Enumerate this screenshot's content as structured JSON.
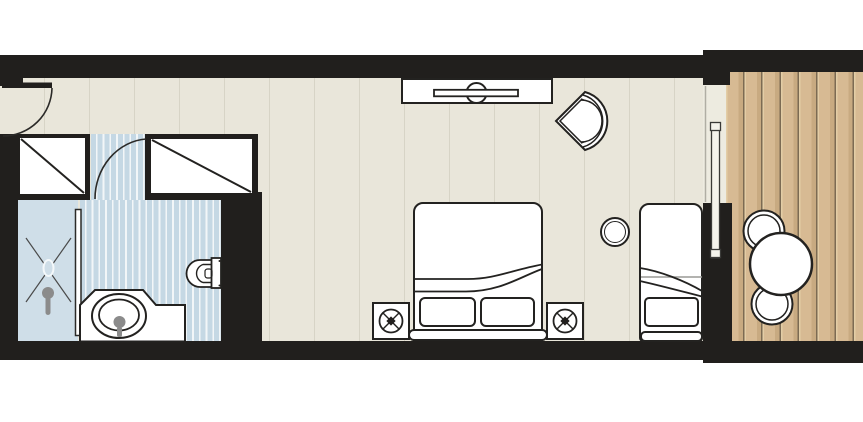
{
  "title": "hotel-room-floor-plan",
  "colors": {
    "page": "#ffffff",
    "wall": "#211f1d",
    "line": "#232220",
    "floor": "#e9e6da",
    "threshold": "#edebe0",
    "shower": "#cfdee8",
    "bath": "#c5d8e4",
    "bath-stripe": "#f2f6f8",
    "deck": "#d7ba93",
    "deck-light": "#e3cda6",
    "deck-dark": "#c8aa81",
    "deck-groove": "#7c6b53",
    "fixture-gray": "#8b8b8b",
    "glass-track": "#b0aea4"
  },
  "plan": {
    "type": "floor-plan",
    "rooms": [
      {
        "name": "entry-corridor"
      },
      {
        "name": "bathroom"
      },
      {
        "name": "bedroom"
      },
      {
        "name": "balcony"
      }
    ],
    "objects": [
      "entry-door-with-swing-arc",
      "wardrobe-left",
      "wardrobe-right",
      "bathroom-door-swing-arc",
      "shower-area",
      "shower-glass-panel",
      "shower-head",
      "washbasin-vanity",
      "sink-basin",
      "tap",
      "toilet",
      "tv-console",
      "tv",
      "armchair",
      "double-bed",
      "pillows",
      "headboard",
      "nightstand-left",
      "nightstand-right",
      "bedside-lamps",
      "round-side-table",
      "daybed",
      "sliding-glass-door",
      "balcony-round-table",
      "balcony-chairs",
      "wood-deck"
    ]
  }
}
